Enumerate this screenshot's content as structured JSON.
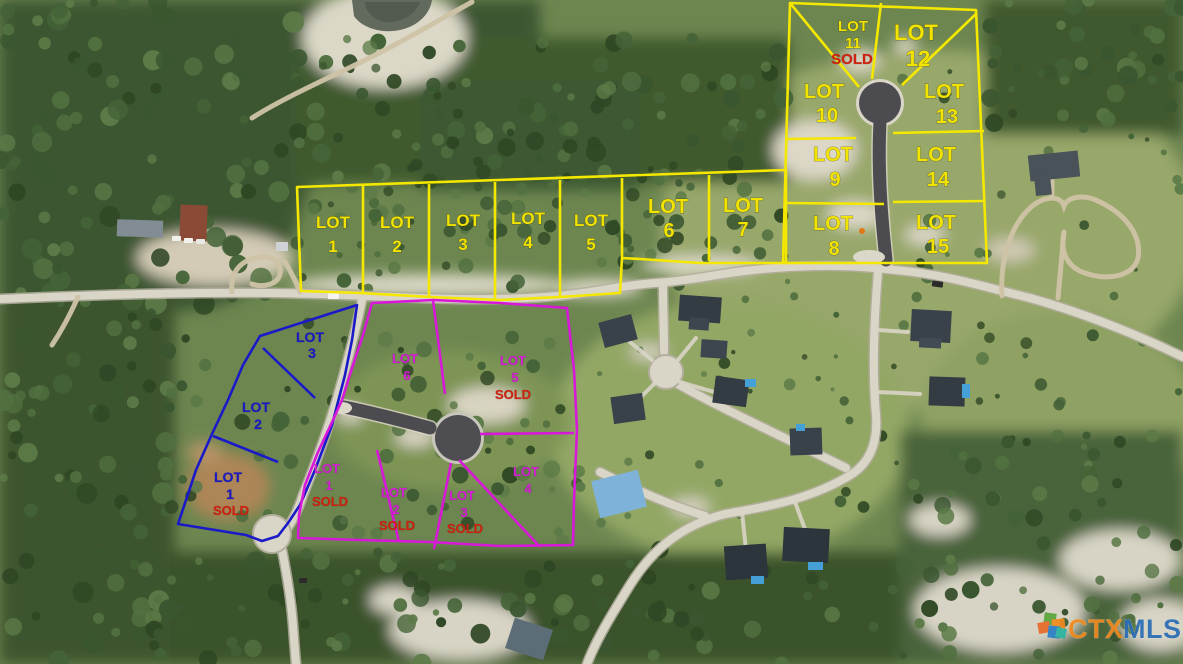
{
  "watermark": {
    "ctx": "CTX",
    "mls": "MLS"
  },
  "colors": {
    "yellow_lines": "#f2e400",
    "blue_lines": "#1a1ac8",
    "magenta_lines": "#d41fd4",
    "sold_red": "#cf2310",
    "ctx_orange": "#f08a1e",
    "mls_blue": "#2a6db5"
  },
  "subdivisions": {
    "yellow": {
      "lots": [
        {
          "word": "LOT",
          "number": "1"
        },
        {
          "word": "LOT",
          "number": "2"
        },
        {
          "word": "LOT",
          "number": "3"
        },
        {
          "word": "LOT",
          "number": "4"
        },
        {
          "word": "LOT",
          "number": "5"
        },
        {
          "word": "LOT",
          "number": "6"
        },
        {
          "word": "LOT",
          "number": "7"
        },
        {
          "word": "LOT",
          "number": "8"
        },
        {
          "word": "LOT",
          "number": "9"
        },
        {
          "word": "LOT",
          "number": "10"
        },
        {
          "word": "LOT",
          "number": "11",
          "status": "SOLD"
        },
        {
          "word": "LOT",
          "number": "12"
        },
        {
          "word": "LOT",
          "number": "13"
        },
        {
          "word": "LOT",
          "number": "14"
        },
        {
          "word": "LOT",
          "number": "15"
        }
      ]
    },
    "blue": {
      "lots": [
        {
          "word": "LOT",
          "number": "1",
          "status": "SOLD"
        },
        {
          "word": "LOT",
          "number": "2"
        },
        {
          "word": "LOT",
          "number": "3"
        }
      ]
    },
    "magenta": {
      "lots": [
        {
          "word": "LOT",
          "number": "1",
          "status": "SOLD"
        },
        {
          "word": "LOT",
          "number": "2",
          "status": "SOLD"
        },
        {
          "word": "LOT",
          "number": "3",
          "status": "SOLD"
        },
        {
          "word": "LOT",
          "number": "4"
        },
        {
          "word": "LOT",
          "number": "5",
          "status": "SOLD"
        },
        {
          "word": "LOT",
          "number": "6"
        }
      ]
    }
  }
}
